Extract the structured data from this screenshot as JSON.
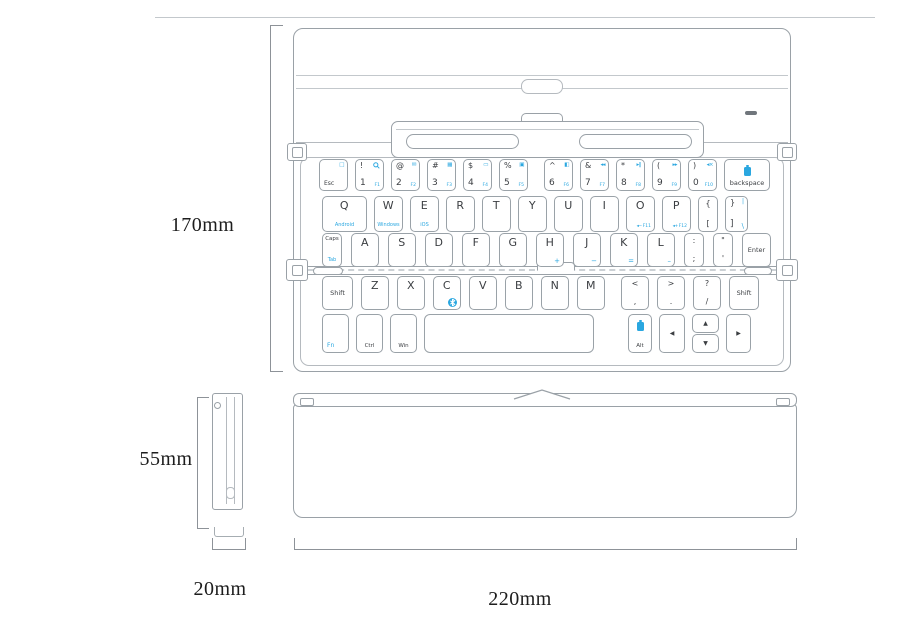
{
  "dimensions": {
    "height": "170mm",
    "folded_height": "55mm",
    "folded_width": "20mm",
    "width": "220mm"
  },
  "colors": {
    "accent": "#2aa7e0",
    "outline": "#9aa1a7",
    "dimension": "#8d9298",
    "led": "#70767c"
  },
  "keyboard": {
    "rows": [
      [
        {
          "name": "esc",
          "tr_icon": "lock",
          "bl_label": "Esc"
        },
        {
          "name": "1",
          "tl": "!",
          "tr_icon": "search",
          "bl": "1",
          "br": "F1"
        },
        {
          "name": "2",
          "tl": "@",
          "tr_icon": "mail",
          "bl": "2",
          "br": "F2"
        },
        {
          "name": "3",
          "tl": "#",
          "tr_icon": "grid",
          "bl": "3",
          "br": "F3"
        },
        {
          "name": "4",
          "tl": "$",
          "tr_icon": "rect",
          "bl": "4",
          "br": "F4"
        },
        {
          "name": "5",
          "tl": "%",
          "tr_icon": "panel",
          "bl": "5",
          "br": "F5"
        },
        {
          "name": "6",
          "tl": "^",
          "tr_icon": "screen",
          "bl": "6",
          "br": "F6"
        },
        {
          "name": "7",
          "tl": "&",
          "tr_icon": "prev",
          "bl": "7",
          "br": "F7"
        },
        {
          "name": "8",
          "tl": "*",
          "tr_icon": "playpause",
          "bl": "8",
          "br": "F8"
        },
        {
          "name": "9",
          "tl": "(",
          "tr_icon": "next",
          "bl": "9",
          "br": "F9"
        },
        {
          "name": "0",
          "tl": ")",
          "tr_icon": "mute",
          "bl": "0",
          "br": "F10"
        },
        {
          "name": "backspace",
          "top_icon": "battery",
          "bot": "backspace"
        }
      ],
      [
        {
          "name": "q",
          "main": "Q",
          "sub": "Android"
        },
        {
          "name": "w",
          "main": "W",
          "sub": "Windows"
        },
        {
          "name": "e",
          "main": "E",
          "sub": "iOS"
        },
        {
          "name": "r",
          "main": "R"
        },
        {
          "name": "t",
          "main": "T"
        },
        {
          "name": "y",
          "main": "Y"
        },
        {
          "name": "u",
          "main": "U"
        },
        {
          "name": "i",
          "main": "I"
        },
        {
          "name": "o",
          "main": "O",
          "br_icon": "voldown",
          "br": "F11"
        },
        {
          "name": "p",
          "main": "P",
          "br_icon": "volup",
          "br": "F12"
        },
        {
          "name": "bracket-left",
          "two": true,
          "tl": "{",
          "bl": "["
        },
        {
          "name": "bracket-right",
          "tl": "}",
          "tr": "|",
          "bl": "]",
          "br": "\\",
          "br_big": true
        }
      ],
      [
        {
          "name": "caps-tab",
          "topt": "Caps",
          "sub": "Tab"
        },
        {
          "name": "a",
          "main": "A"
        },
        {
          "name": "s",
          "main": "S"
        },
        {
          "name": "d",
          "main": "D"
        },
        {
          "name": "f",
          "main": "F"
        },
        {
          "name": "g",
          "main": "G"
        },
        {
          "name": "h",
          "main": "H",
          "br": "+",
          "br_big": true
        },
        {
          "name": "j",
          "main": "J",
          "br": "−",
          "br_big": true
        },
        {
          "name": "k",
          "main": "K",
          "br": "=",
          "br_big": true
        },
        {
          "name": "l",
          "main": "L",
          "br": "–",
          "br_big": true
        },
        {
          "name": "semicolon",
          "two": true,
          "tl": ":",
          "bl": ";"
        },
        {
          "name": "quote",
          "two": true,
          "tl": "\"",
          "bl": "'"
        },
        {
          "name": "enter",
          "mid": "Enter"
        }
      ],
      [
        {
          "name": "shift-left",
          "mid": "Shift"
        },
        {
          "name": "z",
          "main": "Z"
        },
        {
          "name": "x",
          "main": "X"
        },
        {
          "name": "c",
          "main": "C",
          "br_icon": "bluetooth"
        },
        {
          "name": "v",
          "main": "V"
        },
        {
          "name": "b",
          "main": "B"
        },
        {
          "name": "n",
          "main": "N"
        },
        {
          "name": "m",
          "main": "M"
        },
        {
          "name": "comma",
          "two": true,
          "tl": "<",
          "bl": ","
        },
        {
          "name": "period",
          "two": true,
          "tl": ">",
          "bl": "."
        },
        {
          "name": "slash",
          "two": true,
          "tl": "?",
          "bl": "/"
        },
        {
          "name": "shift-right",
          "mid": "Shift"
        }
      ],
      [
        {
          "name": "fn",
          "bl_label": "Fn",
          "blue": true
        },
        {
          "name": "ctrl",
          "bot": "Ctrl"
        },
        {
          "name": "win",
          "bot": "Win"
        },
        {
          "name": "space"
        },
        {
          "name": "alt",
          "top_icon": "battery",
          "bot": "Alt"
        },
        {
          "name": "arrow-left",
          "mid": "◀"
        },
        {
          "name": "arrow-up-down",
          "stack": [
            "▲",
            "▼"
          ]
        },
        {
          "name": "arrow-right",
          "mid": "▶"
        }
      ]
    ]
  }
}
